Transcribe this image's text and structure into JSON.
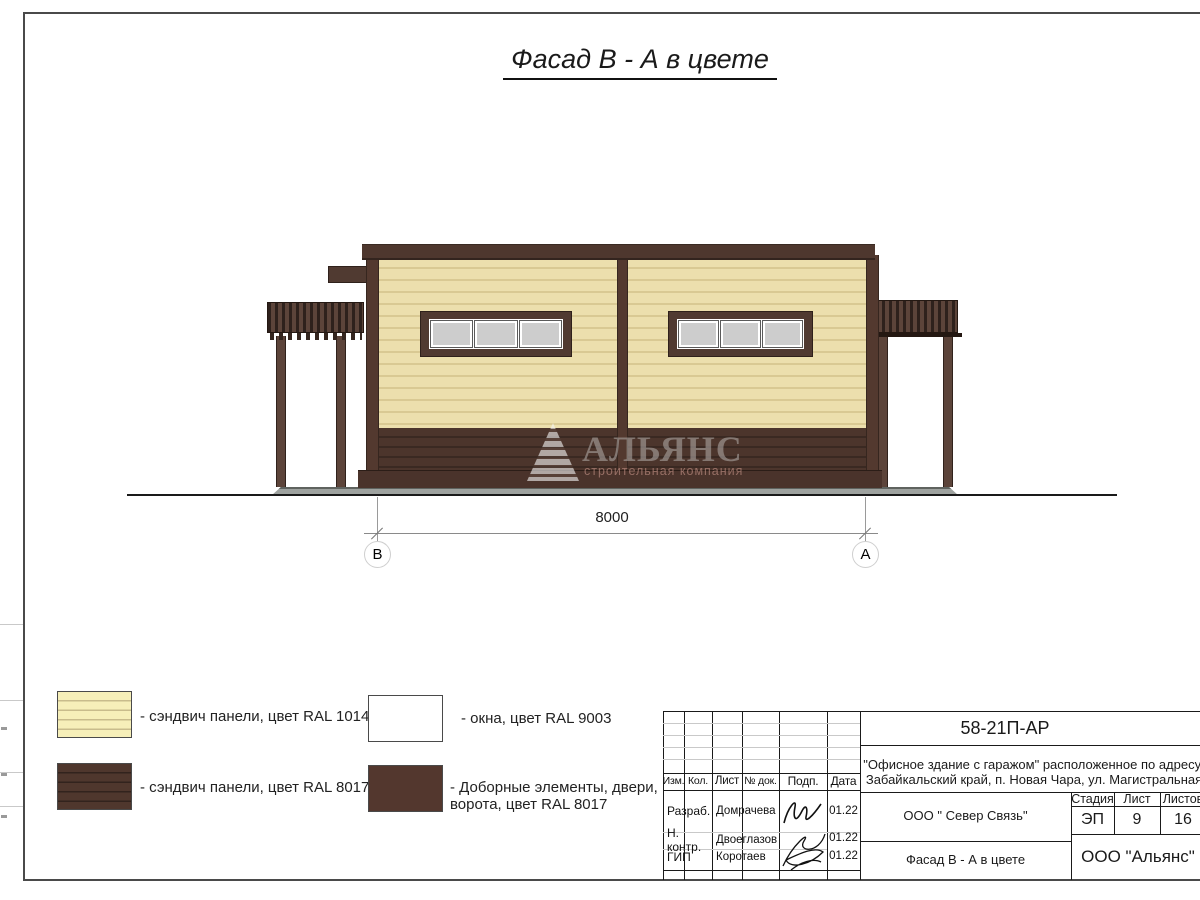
{
  "page": {
    "title": "Фасад В - А в цвете"
  },
  "watermark": {
    "name": "АЛЬЯНС",
    "subtitle": "строительная компания"
  },
  "dimension": {
    "width_mm": "8000",
    "axis_left": "В",
    "axis_right": "А"
  },
  "legend": {
    "items": [
      {
        "label": "- сэндвич панели, цвет RAL 1014"
      },
      {
        "label": "- сэндвич панели, цвет RAL 8017"
      },
      {
        "label": "- окна, цвет RAL 9003"
      },
      {
        "label": "- Доборные элементы, двери, ворота, цвет RAL 8017"
      }
    ]
  },
  "title_block": {
    "doc_code": "58-21П-АР",
    "project_line1": "\"Офисное здание с гаражом\" расположенное по адресу:",
    "project_line2": "Забайкальский край, п. Новая Чара, ул. Магистральная",
    "col_headers": {
      "izm": "Изм.",
      "kol": "Кол.",
      "list": "Лист",
      "doc": "№ док.",
      "podp": "Подп.",
      "data": "Дата"
    },
    "rows": [
      {
        "role": "Разраб.",
        "name": "Домрачева",
        "date": "01.22"
      },
      {
        "role": "Н. контр.",
        "name": "Двоеглазов",
        "date": "01.22"
      },
      {
        "role": "ГИП",
        "name": "Коротаев",
        "date": "01.22"
      }
    ],
    "contractor": "ООО \" Север Связь\"",
    "stage_label": "Стадия",
    "sheet_label": "Лист",
    "sheets_label": "Листов",
    "stage": "ЭП",
    "sheet": "9",
    "sheets": "16",
    "drawing_name": "Фасад В - А в цвете",
    "company": "ООО \"Альянс\""
  },
  "colors": {
    "panel_cream": "#EBDFAC",
    "panel_brown": "#4E372E",
    "window_white": "#FFFFFF",
    "window_pane": "#CDCDCD",
    "accent_dark": "#3A2922",
    "concrete": "#9EA29F"
  }
}
